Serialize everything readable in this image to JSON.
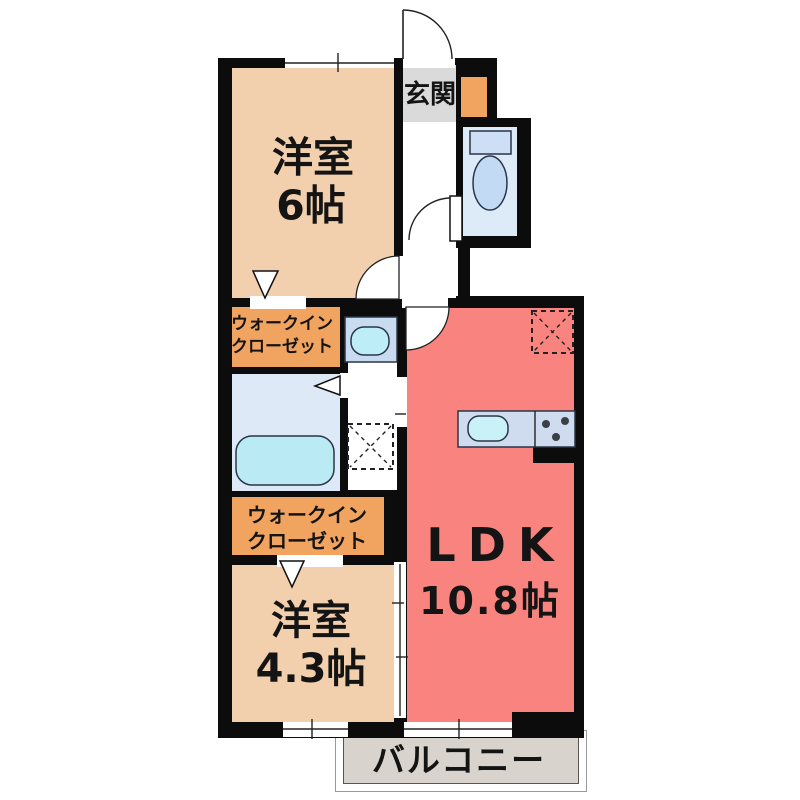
{
  "rooms": {
    "bedroom6": {
      "label": "洋室",
      "size": "6帖"
    },
    "bedroom43": {
      "label": "洋室",
      "size": "4.3帖"
    },
    "ldk": {
      "label": "LDK",
      "size": "10.8帖"
    },
    "entrance": {
      "label": "玄関"
    },
    "wic_upper": {
      "line1": "ウォークイン",
      "line2": "クローゼット"
    },
    "wic_lower": {
      "line1": "ウォークイン",
      "line2": "クローゼット"
    },
    "balcony": {
      "label": "バルコニー"
    }
  },
  "fixtures": {
    "toilet": "toilet",
    "bathtub": "bathtub",
    "washbasin": "washbasin",
    "kitchen_sink": "kitchen-sink",
    "stove": "stove",
    "washer_space": "washing-machine-space",
    "fridge_space": "refrigerator-space"
  },
  "colors": {
    "room_peach": "#f3d0ad",
    "ldk_salmon": "#f9837e",
    "closet_orange": "#f0a45f",
    "entrance_gray": "#dadada",
    "balcony_gray": "#d8d4cd",
    "toilet_blue": "#dcebf7",
    "bath_blue": "#dde9f6",
    "fixture_cyan": "#baebf5",
    "wall_black": "#0c0c0c"
  }
}
